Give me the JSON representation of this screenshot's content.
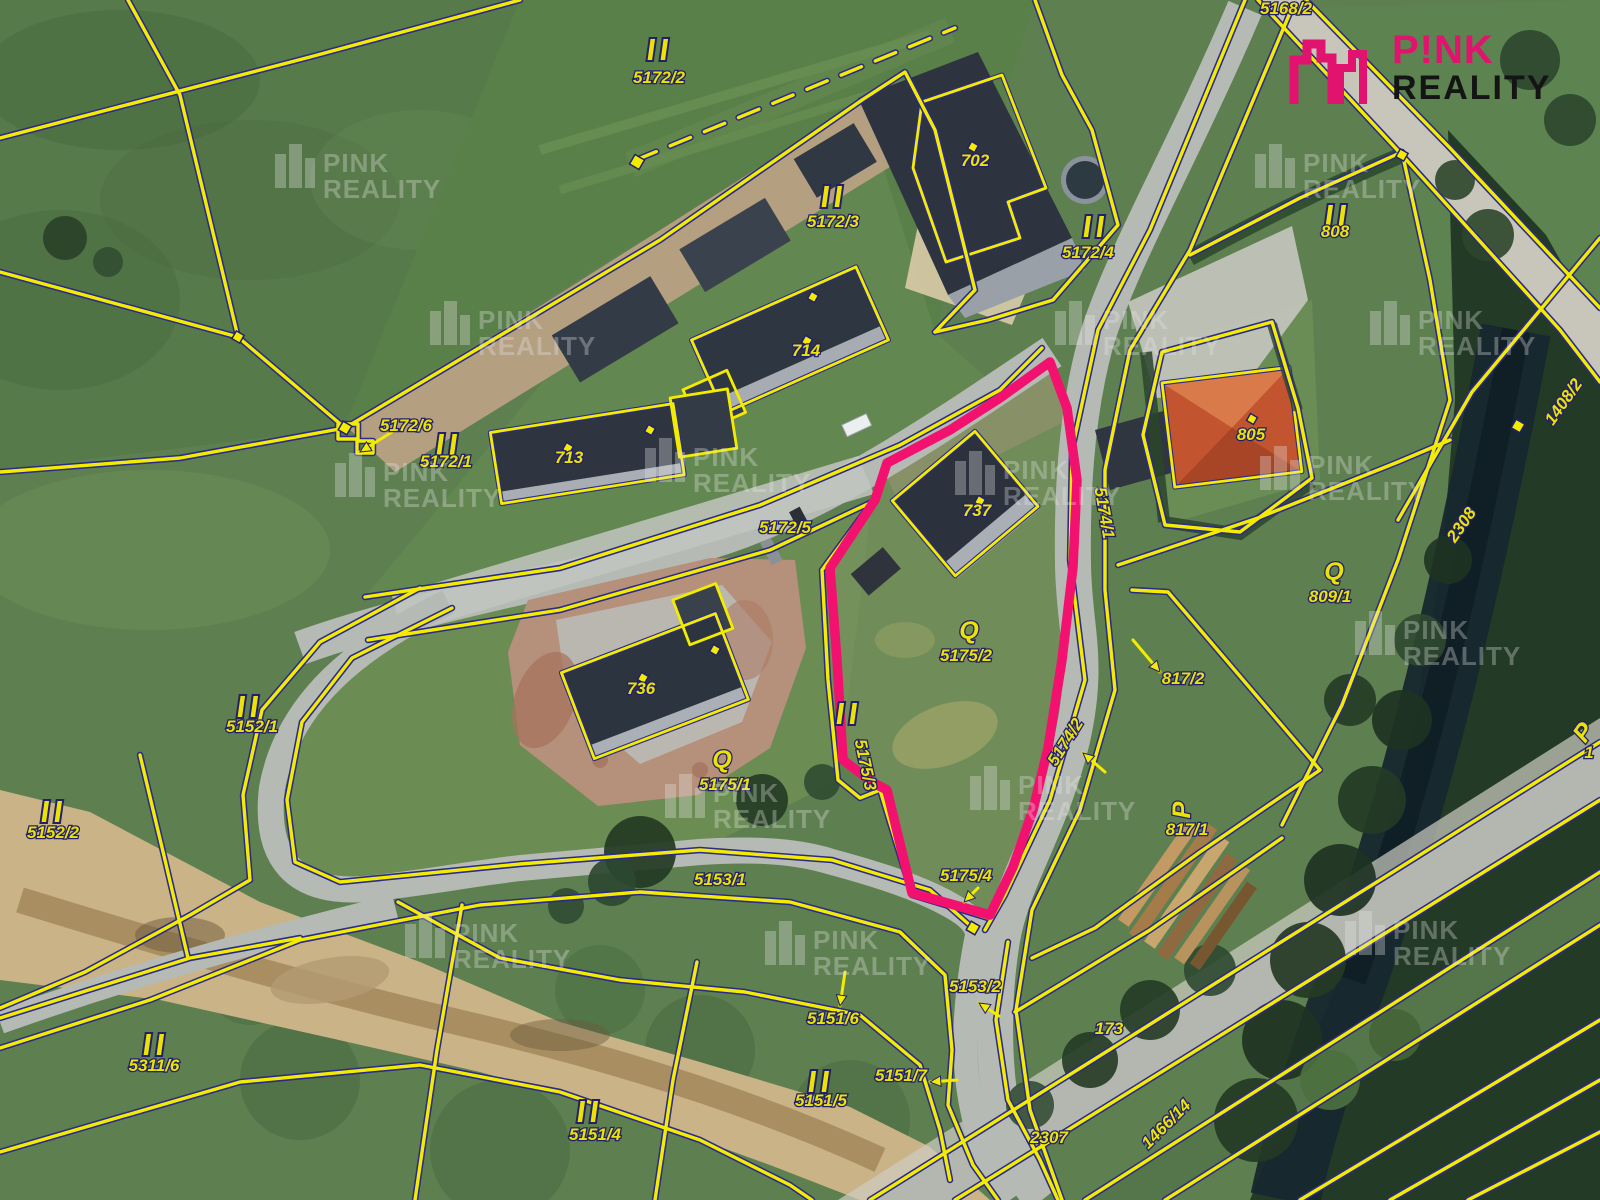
{
  "logo": {
    "line1": "P!NK",
    "line2": "REALITY",
    "accent": "#e2136f",
    "text_color": "#141414"
  },
  "watermark": {
    "line1": "PINK",
    "line2": "REALITY"
  },
  "map": {
    "colors": {
      "cadastral_line": "#f4ec00",
      "cadastral_casing": "#2a2a8a",
      "highlight": "#f2116e",
      "label": "#ece400"
    },
    "labels": [
      {
        "text": "5168/2",
        "x": 1286,
        "y": 14,
        "s": 13
      },
      {
        "text": "5172/2",
        "x": 659,
        "y": 83
      },
      {
        "text": "702",
        "x": 975,
        "y": 166
      },
      {
        "text": "5172/3",
        "x": 833,
        "y": 227
      },
      {
        "text": "5172/4",
        "x": 1088,
        "y": 258
      },
      {
        "text": "808",
        "x": 1335,
        "y": 237
      },
      {
        "text": "714",
        "x": 806,
        "y": 356
      },
      {
        "text": "5172/6",
        "x": 406,
        "y": 431
      },
      {
        "text": "5172/1",
        "x": 446,
        "y": 467
      },
      {
        "text": "713",
        "x": 569,
        "y": 463
      },
      {
        "text": "805",
        "x": 1251,
        "y": 440
      },
      {
        "text": "5172/5",
        "x": 785,
        "y": 533
      },
      {
        "text": "737",
        "x": 977,
        "y": 516
      },
      {
        "text": "5174/1",
        "x": 1099,
        "y": 514,
        "r": 80
      },
      {
        "text": "1408/2",
        "x": 1568,
        "y": 405,
        "r": -55
      },
      {
        "text": "809/1",
        "x": 1330,
        "y": 602
      },
      {
        "text": "5175/2",
        "x": 966,
        "y": 661
      },
      {
        "text": "817/2",
        "x": 1183,
        "y": 684
      },
      {
        "text": "736",
        "x": 641,
        "y": 694
      },
      {
        "text": "5152/1",
        "x": 252,
        "y": 732
      },
      {
        "text": "5174/2",
        "x": 1070,
        "y": 745,
        "r": -58
      },
      {
        "text": "5175/3",
        "x": 860,
        "y": 766,
        "r": 78
      },
      {
        "text": "5175/1",
        "x": 725,
        "y": 790
      },
      {
        "text": "817/1",
        "x": 1187,
        "y": 835
      },
      {
        "text": "5152/2",
        "x": 53,
        "y": 838
      },
      {
        "text": "5153/1",
        "x": 720,
        "y": 885
      },
      {
        "text": "5175/4",
        "x": 966,
        "y": 881
      },
      {
        "text": "2308",
        "x": 1466,
        "y": 528,
        "r": -55
      },
      {
        "text": "5311/6",
        "x": 154,
        "y": 1071
      },
      {
        "text": "5153/2",
        "x": 975,
        "y": 992
      },
      {
        "text": "5151/6",
        "x": 833,
        "y": 1024
      },
      {
        "text": "173",
        "x": 1109,
        "y": 1034
      },
      {
        "text": "5151/7",
        "x": 901,
        "y": 1081
      },
      {
        "text": "5151/5",
        "x": 821,
        "y": 1106
      },
      {
        "text": "2307",
        "x": 1049,
        "y": 1143
      },
      {
        "text": "5151/4",
        "x": 595,
        "y": 1140
      },
      {
        "text": "1466/14",
        "x": 1170,
        "y": 1128,
        "r": -45
      },
      {
        "text": "1",
        "x": 1589,
        "y": 758,
        "s": 14
      }
    ],
    "ii_markers": [
      [
        658,
        50
      ],
      [
        832,
        197
      ],
      [
        1094,
        227
      ],
      [
        1336,
        216
      ],
      [
        447,
        445
      ],
      [
        248,
        707
      ],
      [
        52,
        812
      ],
      [
        847,
        714
      ],
      [
        154,
        1045
      ],
      [
        819,
        1082
      ],
      [
        588,
        1112
      ]
    ],
    "symbols": [
      {
        "glyph": "Q",
        "x": 969,
        "y": 639
      },
      {
        "glyph": "Q",
        "x": 722,
        "y": 768
      },
      {
        "glyph": "Q",
        "x": 1334,
        "y": 580
      },
      {
        "glyph": "P",
        "x": 1190,
        "y": 810,
        "r": -90
      },
      {
        "glyph": "P",
        "x": 1590,
        "y": 737,
        "r": -55
      }
    ],
    "dots": [
      [
        973,
        147,
        8
      ],
      [
        813,
        297,
        8
      ],
      [
        807,
        341,
        8
      ],
      [
        650,
        430,
        8
      ],
      [
        568,
        448,
        8
      ],
      [
        980,
        501,
        8
      ],
      [
        643,
        678,
        8
      ],
      [
        715,
        650,
        8
      ],
      [
        1252,
        419,
        8
      ],
      [
        637,
        162,
        11
      ],
      [
        345,
        428,
        10
      ],
      [
        238,
        337,
        9
      ],
      [
        973,
        928,
        10
      ],
      [
        1518,
        426,
        10
      ],
      [
        1402,
        155,
        9
      ]
    ],
    "arrows": [
      [
        392,
        432,
        360,
        452
      ],
      [
        1133,
        640,
        1160,
        672
      ],
      [
        845,
        972,
        840,
        1006
      ],
      [
        957,
        1080,
        930,
        1082
      ],
      [
        999,
        1016,
        979,
        1003
      ],
      [
        978,
        888,
        964,
        902
      ],
      [
        1105,
        772,
        1083,
        753
      ]
    ],
    "watermarks": [
      [
        365,
        178
      ],
      [
        1345,
        178
      ],
      [
        520,
        335
      ],
      [
        1145,
        335
      ],
      [
        1460,
        335
      ],
      [
        425,
        487
      ],
      [
        735,
        472
      ],
      [
        1045,
        485
      ],
      [
        1350,
        480
      ],
      [
        1445,
        645
      ],
      [
        755,
        808
      ],
      [
        1060,
        800
      ],
      [
        495,
        948
      ],
      [
        855,
        955
      ],
      [
        1435,
        945
      ]
    ]
  }
}
